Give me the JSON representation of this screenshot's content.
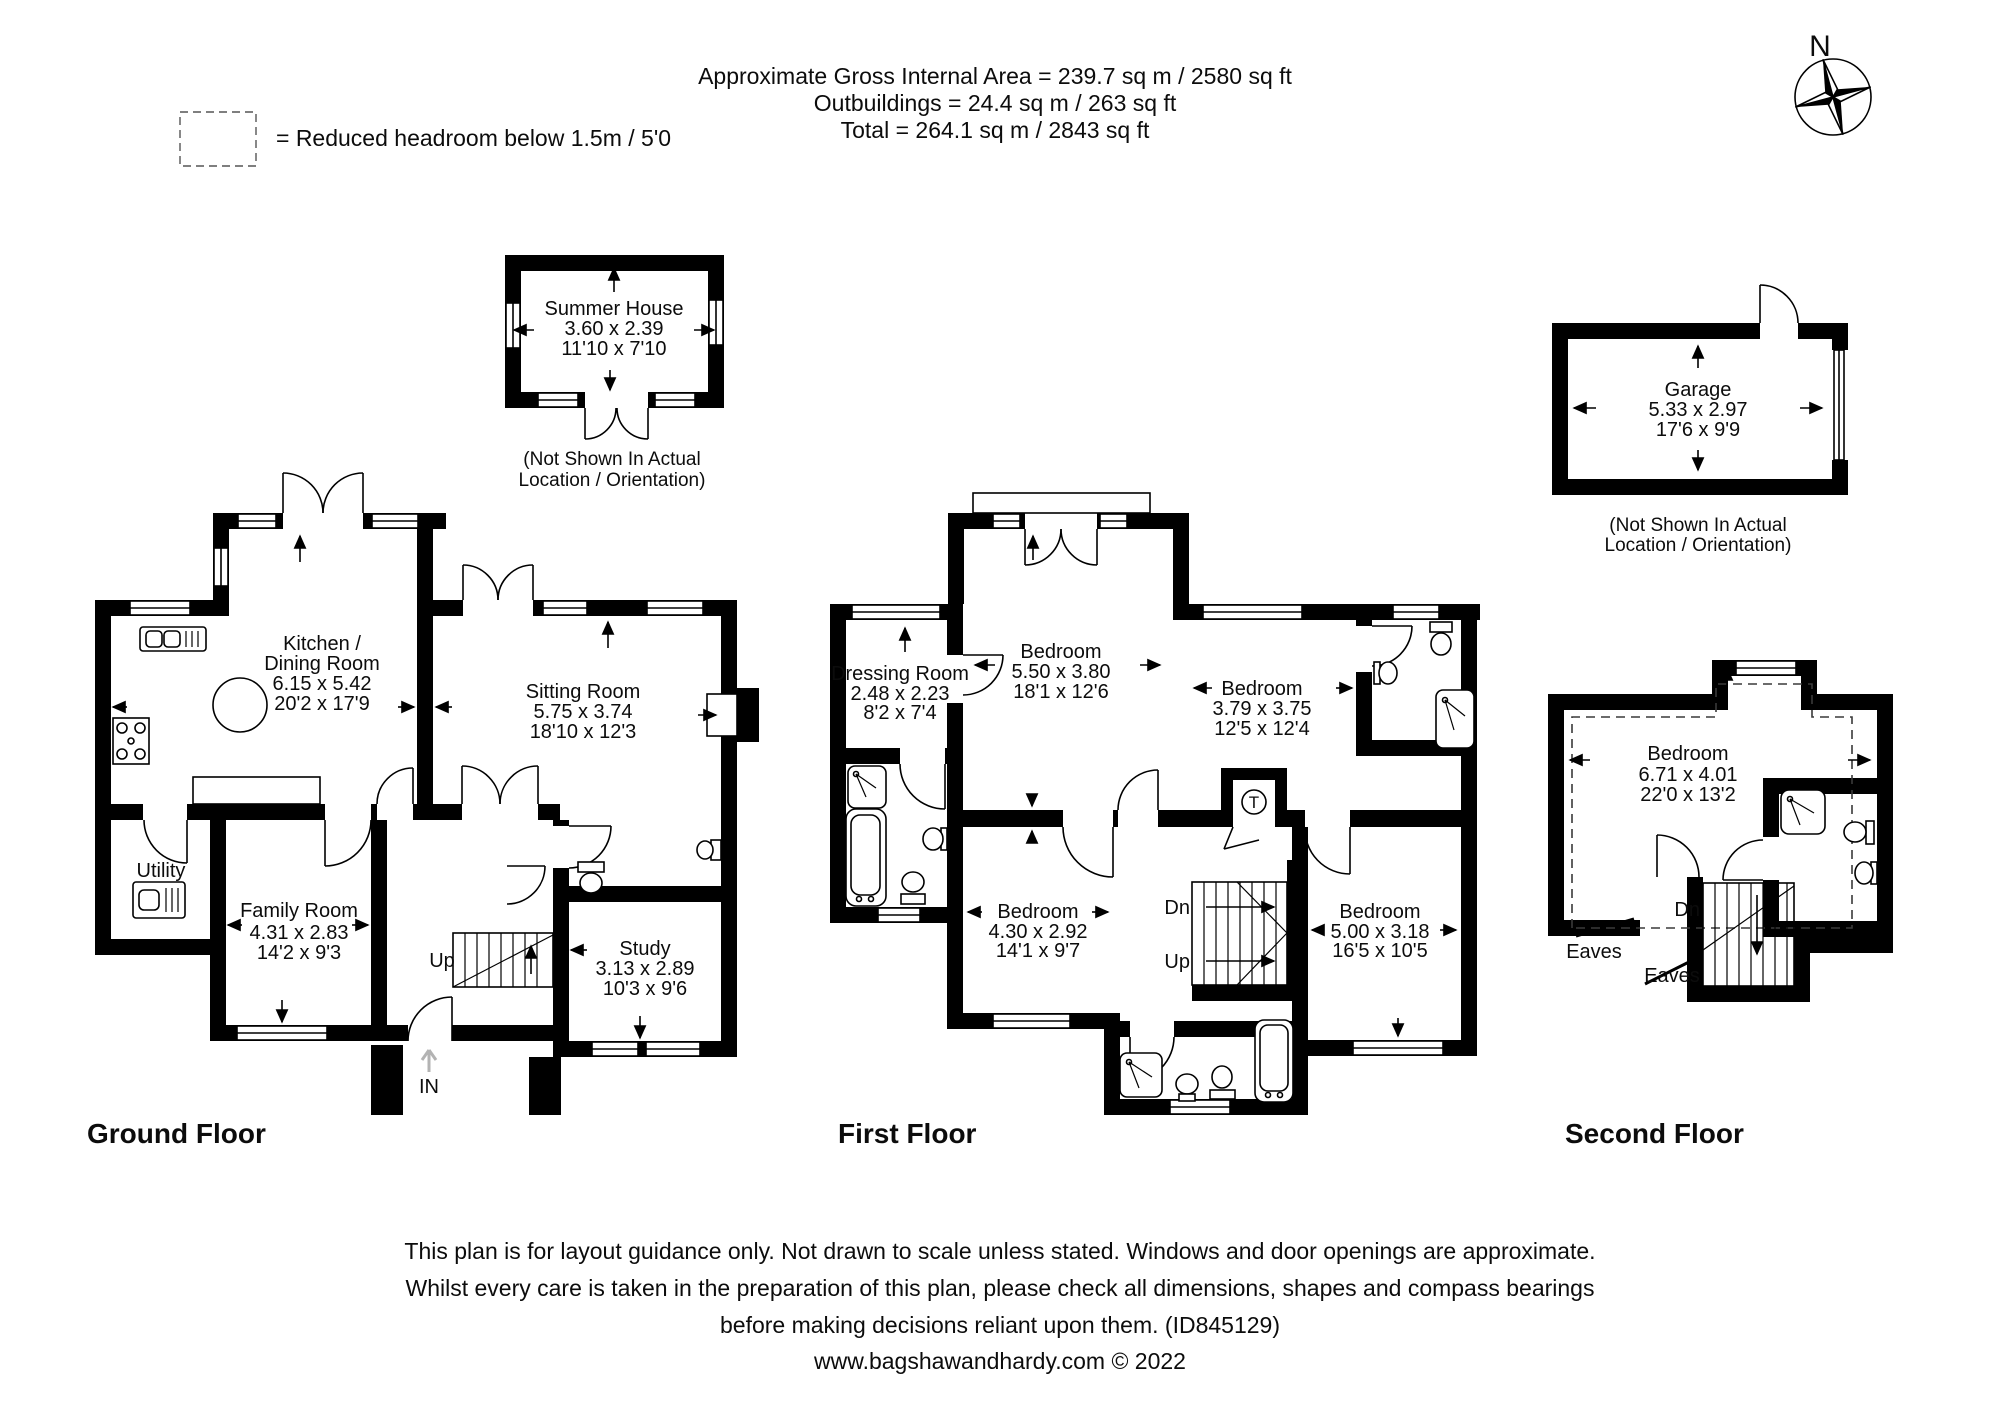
{
  "header": {
    "line1": "Approximate Gross Internal Area = 239.7 sq m / 2580 sq ft",
    "line2": "Outbuildings = 24.4 sq m / 263 sq ft",
    "line3": "Total = 264.1 sq m / 2843 sq ft"
  },
  "legend": {
    "text": "= Reduced headroom below 1.5m / 5'0"
  },
  "compass": {
    "north": "N"
  },
  "outbuildings": {
    "summer_house": {
      "name": "Summer House",
      "metric": "3.60 x 2.39",
      "imperial": "11'10 x 7'10"
    },
    "garage": {
      "name": "Garage",
      "metric": "5.33 x 2.97",
      "imperial": "17'6 x 9'9"
    },
    "note_line1": "(Not Shown In Actual",
    "note_line2": "Location / Orientation)"
  },
  "ground_floor": {
    "title": "Ground Floor",
    "kitchen": {
      "name1": "Kitchen /",
      "name2": "Dining Room",
      "metric": "6.15 x 5.42",
      "imperial": "20'2 x 17'9"
    },
    "sitting": {
      "name": "Sitting Room",
      "metric": "5.75 x 3.74",
      "imperial": "18'10 x 12'3"
    },
    "family": {
      "name": "Family Room",
      "metric": "4.31 x 2.83",
      "imperial": "14'2 x 9'3"
    },
    "study": {
      "name": "Study",
      "metric": "3.13 x 2.89",
      "imperial": "10'3 x 9'6"
    },
    "utility": "Utility",
    "up": "Up",
    "entrance": "IN"
  },
  "first_floor": {
    "title": "First Floor",
    "dressing": {
      "name": "Dressing Room",
      "metric": "2.48 x 2.23",
      "imperial": "8'2 x 7'4"
    },
    "bedroom1": {
      "name": "Bedroom",
      "metric": "5.50 x 3.80",
      "imperial": "18'1 x 12'6"
    },
    "bedroom2": {
      "name": "Bedroom",
      "metric": "3.79 x 3.75",
      "imperial": "12'5 x 12'4"
    },
    "bedroom3": {
      "name": "Bedroom",
      "metric": "4.30 x 2.92",
      "imperial": "14'1 x 9'7"
    },
    "bedroom4": {
      "name": "Bedroom",
      "metric": "5.00 x 3.18",
      "imperial": "16'5 x 10'5"
    },
    "dn": "Dn",
    "up": "Up",
    "tank": "T"
  },
  "second_floor": {
    "title": "Second Floor",
    "bedroom": {
      "name": "Bedroom",
      "metric": "6.71 x 4.01",
      "imperial": "22'0 x 13'2"
    },
    "dn": "Dn",
    "eaves": "Eaves"
  },
  "footer": {
    "line1": "This plan is for layout guidance only. Not drawn to scale unless stated. Windows and door openings are approximate.",
    "line2": "Whilst every care is taken in the preparation of this plan, please check all dimensions, shapes and compass bearings",
    "line3": "before making decisions reliant upon them. (ID845129)",
    "line4": "www.bagshawandhardy.com © 2022"
  }
}
